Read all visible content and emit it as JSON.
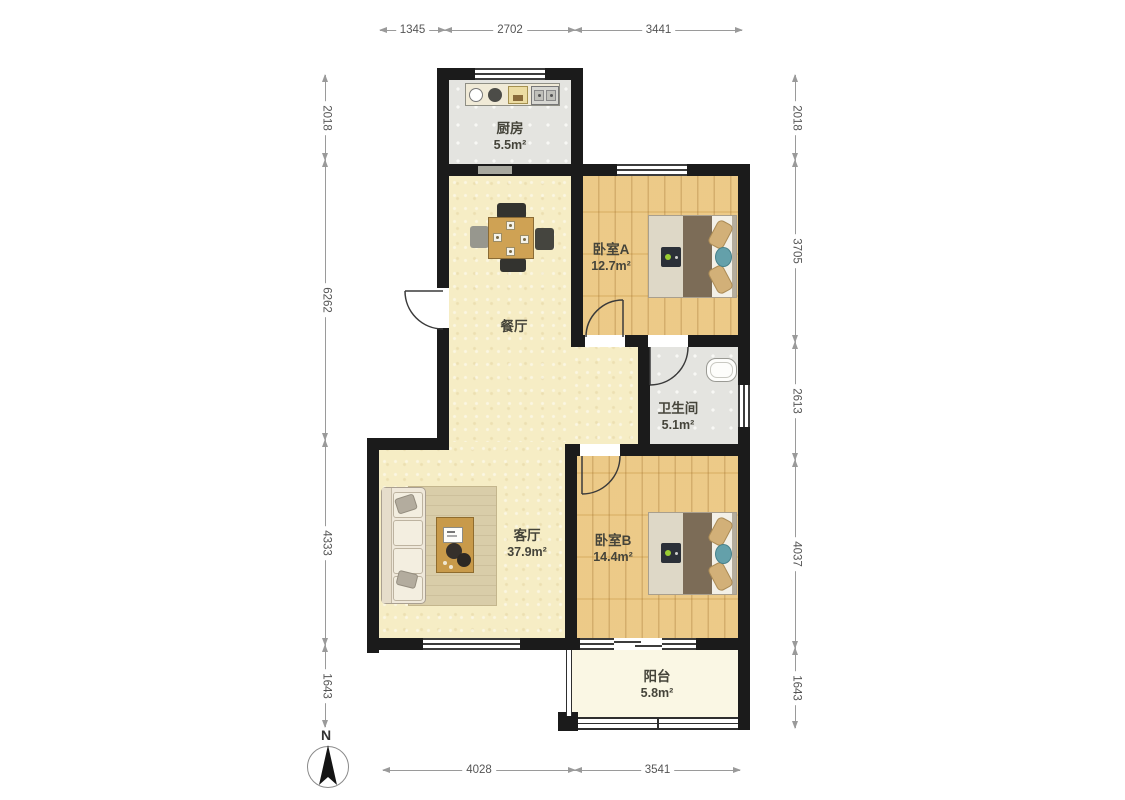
{
  "compass": {
    "label": "N"
  },
  "rooms": {
    "kitchen": {
      "name": "厨房",
      "area": "5.5m²"
    },
    "bedroom_a": {
      "name": "卧室A",
      "area": "12.7m²"
    },
    "dining": {
      "name": "餐厅"
    },
    "bathroom": {
      "name": "卫生间",
      "area": "5.1m²"
    },
    "living": {
      "name": "客厅",
      "area": "37.9m²"
    },
    "bedroom_b": {
      "name": "卧室B",
      "area": "14.4m²"
    },
    "balcony": {
      "name": "阳台",
      "area": "5.8m²"
    }
  },
  "dimensions": {
    "top": [
      "1345",
      "2702",
      "3441"
    ],
    "bottom": [
      "4028",
      "3541"
    ],
    "left": [
      "2018",
      "6262",
      "4333",
      "1643"
    ],
    "right": [
      "2018",
      "3705",
      "2613",
      "4037",
      "1643"
    ]
  },
  "colors": {
    "wall": "#1b1b1b",
    "wood_floor": "#ebc67e",
    "tile_floor": "#e4e4e0",
    "main_floor": "#f6edc5",
    "balcony_floor": "#faf7e4",
    "accent_teal": "#64a0aa"
  }
}
